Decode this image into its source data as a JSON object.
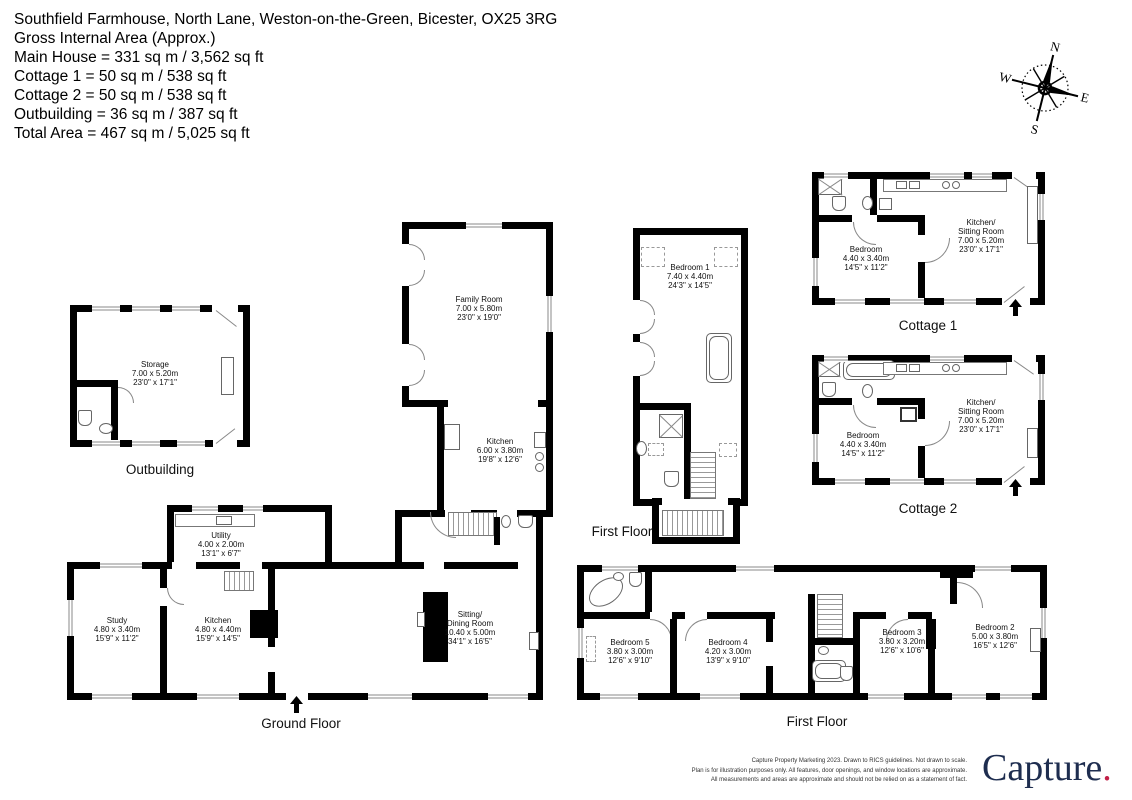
{
  "header": {
    "address": "Southfield Farmhouse, North Lane, Weston-on-the-Green, Bicester, OX25 3RG",
    "area_label": "Gross Internal Area (Approx.)",
    "lines": [
      "Main House = 331 sq m / 3,562 sq ft",
      "Cottage 1 = 50 sq m /  538 sq ft",
      "Cottage 2 = 50 sq m / 538 sq ft",
      "Outbuilding = 36 sq m / 387 sq ft",
      "Total Area = 467 sq m / 5,025 sq ft"
    ]
  },
  "compass": {
    "north": "N",
    "east": "E",
    "south": "S",
    "west": "W"
  },
  "sections": {
    "outbuilding": "Outbuilding",
    "ground_floor": "Ground Floor",
    "first_floor_main": "First Floor",
    "first_floor_wing": "First Floor",
    "cottage1": "Cottage 1",
    "cottage2": "Cottage 2"
  },
  "rooms": {
    "storage": {
      "name": "Storage",
      "metric": "7.00 x 5.20m",
      "imperial": "23'0\" x 17'1\""
    },
    "family_room": {
      "name": "Family Room",
      "metric": "7.00 x 5.80m",
      "imperial": "23'0\" x 19'0\""
    },
    "kitchen_wing": {
      "name": "Kitchen",
      "metric": "6.00 x 3.80m",
      "imperial": "19'8\" x 12'6\""
    },
    "utility": {
      "name": "Utility",
      "metric": "4.00 x 2.00m",
      "imperial": "13'1\" x 6'7\""
    },
    "study": {
      "name": "Study",
      "metric": "4.80 x 3.40m",
      "imperial": "15'9\" x 11'2\""
    },
    "kitchen_gf": {
      "name": "Kitchen",
      "metric": "4.80 x 4.40m",
      "imperial": "15'9\" x 14'5\""
    },
    "sitting_dining": {
      "name": "Sitting/",
      "name2": "Dining Room",
      "metric": "10.40 x 5.00m",
      "imperial": "34'1\" x 16'5\""
    },
    "bedroom1": {
      "name": "Bedroom 1",
      "metric": "7.40 x 4.40m",
      "imperial": "24'3\" x 14'5\""
    },
    "c1_bedroom": {
      "name": "Bedroom",
      "metric": "4.40 x 3.40m",
      "imperial": "14'5\" x 11'2\""
    },
    "c1_kitchen": {
      "name": "Kitchen/",
      "name2": "Sitting Room",
      "metric": "7.00 x 5.20m",
      "imperial": "23'0\" x 17'1\""
    },
    "c2_bedroom": {
      "name": "Bedroom",
      "metric": "4.40 x 3.40m",
      "imperial": "14'5\" x 11'2\""
    },
    "c2_kitchen": {
      "name": "Kitchen/",
      "name2": "Sitting Room",
      "metric": "7.00 x 5.20m",
      "imperial": "23'0\" x 17'1\""
    },
    "bedroom5": {
      "name": "Bedroom 5",
      "metric": "3.80 x 3.00m",
      "imperial": "12'6\" x 9'10\""
    },
    "bedroom4": {
      "name": "Bedroom 4",
      "metric": "4.20 x 3.00m",
      "imperial": "13'9\" x 9'10\""
    },
    "bedroom3": {
      "name": "Bedroom 3",
      "metric": "3.80 x 3.20m",
      "imperial": "12'6\" x 10'6\""
    },
    "bedroom2": {
      "name": "Bedroom 2",
      "metric": "5.00 x 3.80m",
      "imperial": "16'5\" x 12'6\""
    }
  },
  "footer": {
    "line1": "Capture Property Marketing 2023. Drawn to RICS guidelines.  Not drawn to scale.",
    "line2": "Plan is for illustration purposes only. All features, door openings, and window locations are approximate.",
    "line3": "All measurements and areas are approximate and should not be relied on as a statement of fact.",
    "logo": "Capture",
    "logo_dot": ".",
    "logo_color": "#1e2d4f",
    "logo_dot_color": "#c22047"
  }
}
